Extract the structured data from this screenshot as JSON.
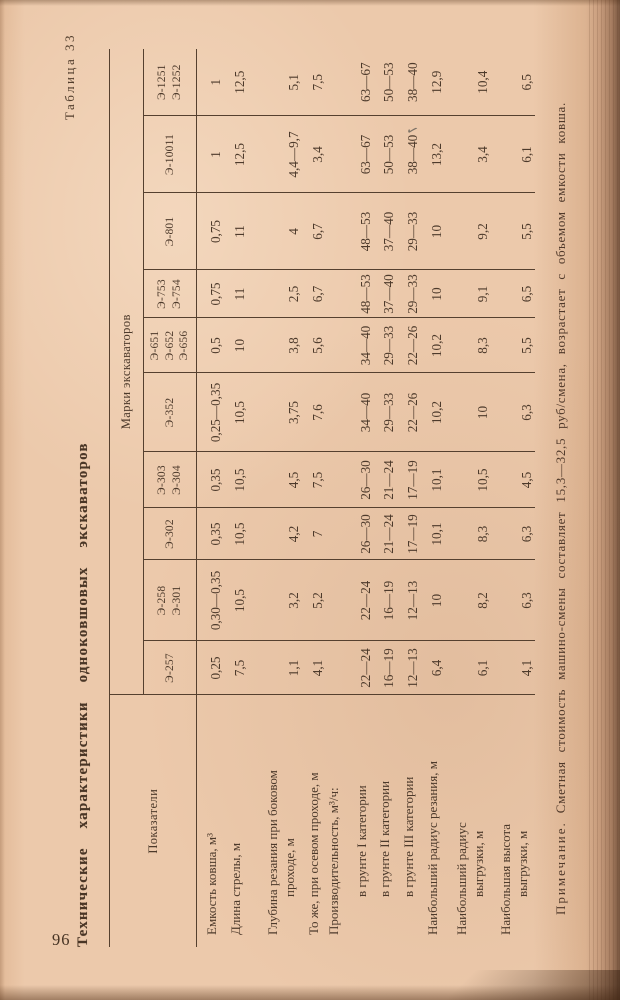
{
  "page": {
    "number": "96",
    "table_label": "Таблица 33",
    "title": "Технические  характеристики  одноковшовых  экскаваторов",
    "note_label": "Примечание.",
    "note_body": "Сметная стоимость машино-смены составляет 15,3—32,5 руб/смена, возрастает с объемом емкости ковша."
  },
  "table": {
    "corner_header": "Показатели",
    "group_header": "Марки экскаваторов",
    "columns": [
      "Э-257",
      "Э-258\nЭ-301",
      "Э-302",
      "Э-303\nЭ-304",
      "Э-352",
      "Э-651\nЭ-652\nЭ-656",
      "Э-753\nЭ-754",
      "Э-801",
      "Э-10011",
      "Э-1251\nЭ-1252"
    ],
    "rows": [
      {
        "label": "Емкость ковша, м³",
        "values": [
          "0,25",
          "0,30—0,35",
          "0,35",
          "0,35",
          "0,25—0,35",
          "0,5",
          "0,75",
          "0,75",
          "1",
          "1"
        ]
      },
      {
        "label": "Длина стрелы, м",
        "values": [
          "7,5",
          "10,5",
          "10,5",
          "10,5",
          "10,5",
          "10",
          "11",
          "11",
          "12,5",
          "12,5"
        ]
      },
      {
        "label": "Глубина резания при боковом\nпроходе, м",
        "values": [
          "1,1",
          "3,2",
          "4,2",
          "4,5",
          "3,75",
          "3,8",
          "2,5",
          "4",
          "4,4—9,7",
          "5,1"
        ]
      },
      {
        "label": "То же, при осевом проходе, м",
        "values": [
          "4,1",
          "5,2",
          "7",
          "7,5",
          "7,6",
          "5,6",
          "6,7",
          "6,7",
          "3,4",
          "7,5"
        ]
      },
      {
        "label": "Производительность, м³/ч:",
        "values": [
          "",
          "",
          "",
          "",
          "",
          "",
          "",
          "",
          "",
          ""
        ]
      },
      {
        "label": "в грунте I категории",
        "indent": true,
        "values": [
          "22—24",
          "22—24",
          "26—30",
          "26—30",
          "34—40",
          "34—40",
          "48—53",
          "48—53",
          "63—67",
          "63—67"
        ]
      },
      {
        "label": "в грунте II категории",
        "indent": true,
        "values": [
          "16—19",
          "16—19",
          "21—24",
          "21—24",
          "29—33",
          "29—33",
          "37—40",
          "37—40",
          "50—53",
          "50—53"
        ]
      },
      {
        "label": "в грунте III категории",
        "indent": true,
        "values": [
          "12—13",
          "12—13",
          "17—19",
          "17—19",
          "22—26",
          "22—26",
          "29—33",
          "29—33",
          "38—40",
          "38—40"
        ]
      },
      {
        "label": "Наибольший радиус резания, м",
        "values": [
          "6,4",
          "10",
          "10,1",
          "10,1",
          "10,2",
          "10,2",
          "10",
          "10",
          "13,2",
          "12,9"
        ]
      },
      {
        "label": "Наибольший радиус\nвыгрузки, м",
        "values": [
          "6,1",
          "8,2",
          "8,3",
          "10,5",
          "10",
          "8,3",
          "9,1",
          "9,2",
          "3,4",
          "10,4"
        ]
      },
      {
        "label": "Наибольшая высота\nвыгрузки, м",
        "values": [
          "4,1",
          "6,3",
          "6,3",
          "4,5",
          "6,3",
          "5,5",
          "6,5",
          "5,5",
          "6,1",
          "6,5"
        ]
      }
    ],
    "column_widths_px": [
      54,
      81,
      52,
      56,
      79,
      55,
      48,
      77,
      77,
      67
    ]
  },
  "marks": {
    "pen_tick": "✓"
  },
  "colors": {
    "paper": "#ecc9ab",
    "ink": "#4d3a2b",
    "rule": "#55402f",
    "edge_dark": "#422614"
  }
}
